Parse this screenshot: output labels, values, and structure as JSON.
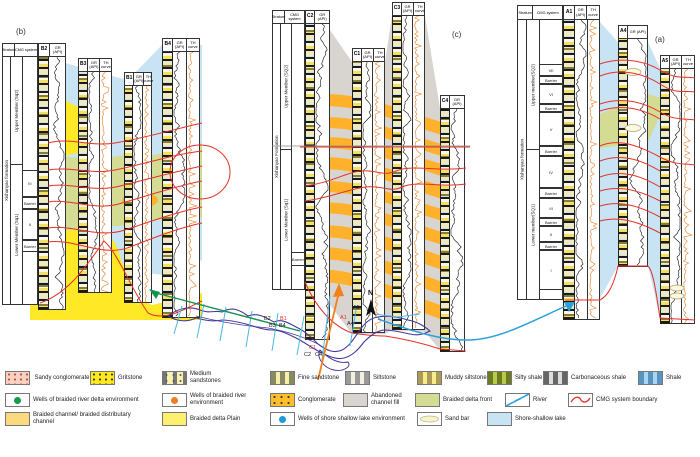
{
  "figure_labels": {
    "b": "(b)",
    "c": "(c)",
    "a": "(a)"
  },
  "colors": {
    "shore_shallow_lake": "#c7e3f4",
    "braided_delta_plain": "#ffe926",
    "braided_delta_front": "#d4db92",
    "braided_channel": "#ffb12b",
    "abandoned_channel_fill": "#d8d4d0",
    "cmg_boundary_red": "#e53128",
    "river_blue": "#35a3dc",
    "map_outline_purple": "#44379b",
    "arrow_green": "#14934d",
    "arrow_orange": "#f0821e",
    "well_delta_dot_green": "#159b4b",
    "well_river_dot_orange": "#f07d22",
    "well_lake_dot_blue": "#1e9cd7"
  },
  "panels": {
    "b": {
      "tag": "(b)",
      "stratum_header": "Stratum",
      "cmg_header": "CMG system",
      "formation": "Xishanyao formation",
      "upper_member": "Upper Member (Sq2)",
      "lower_member": "Lower Member (Sq1)",
      "units": [
        "III",
        "Barrier",
        "II",
        "Barrier"
      ],
      "wells": [
        {
          "name": "B2",
          "gr": "GR (API)"
        },
        {
          "name": "B3",
          "gr": "GR (API)",
          "th": "TH curve"
        },
        {
          "name": "B1",
          "gr": "GR (API)",
          "th": "TH curve"
        },
        {
          "name": "B4",
          "gr": "GR (API)",
          "th": "TH curve"
        }
      ]
    },
    "c": {
      "tag": "(c)",
      "stratum_header": "Stratum",
      "cmg_header": "CMG system",
      "formation": "Xishanyao Formation",
      "upper_member": "Upper Member (SQ2)",
      "lower_member": "Lower Member (Sq1)",
      "units": [
        "Barrier"
      ],
      "wells": [
        {
          "name": "C2",
          "gr": "GR (API)"
        },
        {
          "name": "C1",
          "gr": "GR (API)",
          "th": "TH curve"
        },
        {
          "name": "C3",
          "gr": "GR (API)",
          "th": "TH curve"
        },
        {
          "name": "C4",
          "gr": "GR (API)"
        }
      ]
    },
    "a": {
      "tag": "(a)",
      "stratum_header": "Stratum",
      "cmg_header": "CMG system",
      "formation": "Xishanyao formation",
      "upper_member": "Upper member(SQ2)",
      "lower_member": "Lower member(SQ1)",
      "units": [
        "VII",
        "Barrier",
        "VI",
        "Barrier",
        "V",
        "Barrier",
        "IV",
        "Barrier",
        "III",
        "Barrier",
        "II",
        "Barrier",
        "I"
      ],
      "wells": [
        {
          "name": "A1",
          "gr": "GR (API)",
          "th": "TH curve"
        },
        {
          "name": "A4",
          "gr": "GR (API)"
        },
        {
          "name": "A5",
          "gr": "GR (API)",
          "th": "TH curve"
        }
      ]
    }
  },
  "map": {
    "north": "N",
    "labels": {
      "b2": "B2",
      "b1": "B1",
      "b3": "B3",
      "b4": "B4",
      "c1": "C1",
      "c2": "C2",
      "c4": "C4",
      "a5": "A5",
      "a1": "A1",
      "a4": "A4"
    }
  },
  "legend": {
    "items": [
      {
        "label": "Sandy conglomerate"
      },
      {
        "label": "Gritstone"
      },
      {
        "label": "Medium sandstones"
      },
      {
        "label": "Fine sandstone"
      },
      {
        "label": "Siltstone"
      },
      {
        "label": "Muddy siltstone"
      },
      {
        "label": "Silty shale"
      },
      {
        "label": "Carbonaceous shale"
      },
      {
        "label": "Shale"
      },
      {
        "label": "Wells of braided river delta environment"
      },
      {
        "label": "Wells of braided river environment"
      },
      {
        "label": "Conglomerate"
      },
      {
        "label": "Abandoned channel fill"
      },
      {
        "label": "Braided delta front"
      },
      {
        "label": "River"
      },
      {
        "label": "CMG system boundary"
      },
      {
        "label": "Braided channel/ braided distributary channel"
      },
      {
        "label": "Braided delta Plain"
      },
      {
        "label": "Wells of shore shallow lake environment"
      },
      {
        "label": "Sand bar"
      },
      {
        "label": "Shore-shallow lake"
      }
    ]
  }
}
